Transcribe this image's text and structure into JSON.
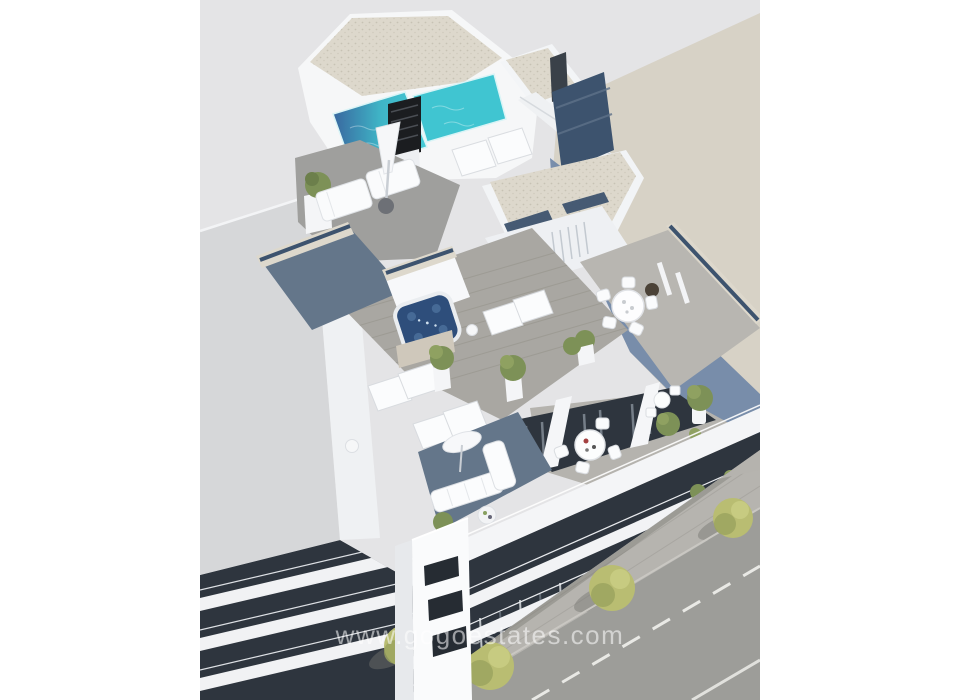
{
  "render": {
    "type": "3D architectural exterior render",
    "subject": "Aerial corner view of a modern white apartment building with rooftop pool, jacuzzi terrace, sun loungers, balconies and street below",
    "watermark": "www.gogoestates.com",
    "elements": [
      "rooftop-swimming-pool",
      "roof-chimney",
      "gravel-roof",
      "jacuzzi-hot-tub",
      "sun-loungers",
      "parasol",
      "daybeds",
      "outdoor-dining-set",
      "bistro-set",
      "potted-plants",
      "balcony-sofa",
      "glass-railings",
      "balcony-bands",
      "neighbor-building",
      "building-shadow",
      "street-road",
      "lane-markings",
      "sidewalk-trees"
    ]
  },
  "colors": {
    "page_margin": "#ffffff",
    "canvas_bg": "#e4e4e6",
    "ground_beige": "#d7d2c6",
    "building_shadow": "#7389a9",
    "building_white": "#f6f7f8",
    "gravel_roof": "#ddd8cc",
    "pool_shallow": "#40c5d1",
    "pool_deep": "#39679f",
    "jacuzzi_water": "#2e4e7b",
    "glass_railing": "#3d536e",
    "deck_sunlit": "#a9a7a2",
    "deck_shaded": "#64768a",
    "window_dark": "#2e353e",
    "road": "#9d9d99",
    "sidewalk": "#b6b4af",
    "road_marking": "#e9e9e5",
    "tree_foliage": "#b9bd72",
    "plant_green": "#7d9157",
    "neighbor_wall": "#d6d7d9",
    "watermark_color": "rgba(255,255,255,0.55)"
  }
}
